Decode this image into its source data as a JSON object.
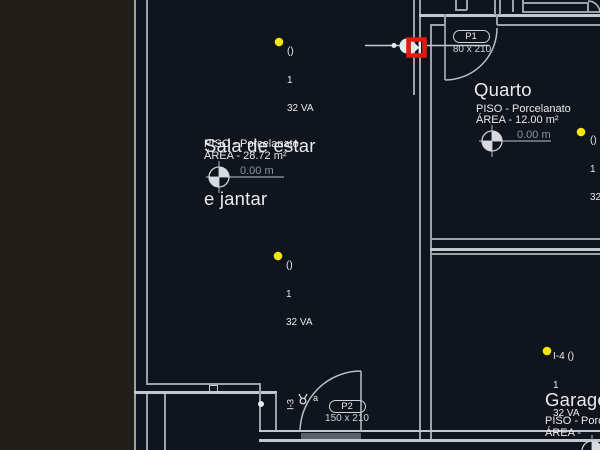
{
  "canvas": {
    "background_color": "#10151d",
    "offsheet_color": "#221f1b",
    "wall_color": "#9ba2aa",
    "selection_color": "#e6190e",
    "light_color": "#f3e70c"
  },
  "rooms": {
    "sala": {
      "title_line1": "Sala de estar",
      "title_line2": "e jantar",
      "floor": "PISO - Porcelanato",
      "area": "ÁREA - 28.72 m²",
      "level": "0.00 m"
    },
    "quarto": {
      "title": "Quarto",
      "floor": "PISO - Porcelanato",
      "area": "ÁREA - 12.00 m²",
      "level": "0.00 m"
    },
    "garagem": {
      "title": "Garagem",
      "floor": "PISO - Porcelanato",
      "area": "ÁREA - "
    }
  },
  "doors": {
    "p1": {
      "tag": "P1",
      "size": "80 x 210"
    },
    "p2": {
      "tag": "P2",
      "size": "150 x 210"
    }
  },
  "lights": {
    "sala_top": {
      "tag": "()",
      "qty": "1",
      "power": "32 VA"
    },
    "sala_mid": {
      "tag": "()",
      "qty": "1",
      "power": "32 VA"
    },
    "quarto": {
      "tag": "()",
      "qty": "1",
      "power": "32 VA"
    },
    "area4": {
      "tag": "I-4 ()",
      "qty": "1",
      "power": "32 VA"
    }
  },
  "annotations": {
    "circuit": "I-3",
    "switch_letter": "a"
  }
}
